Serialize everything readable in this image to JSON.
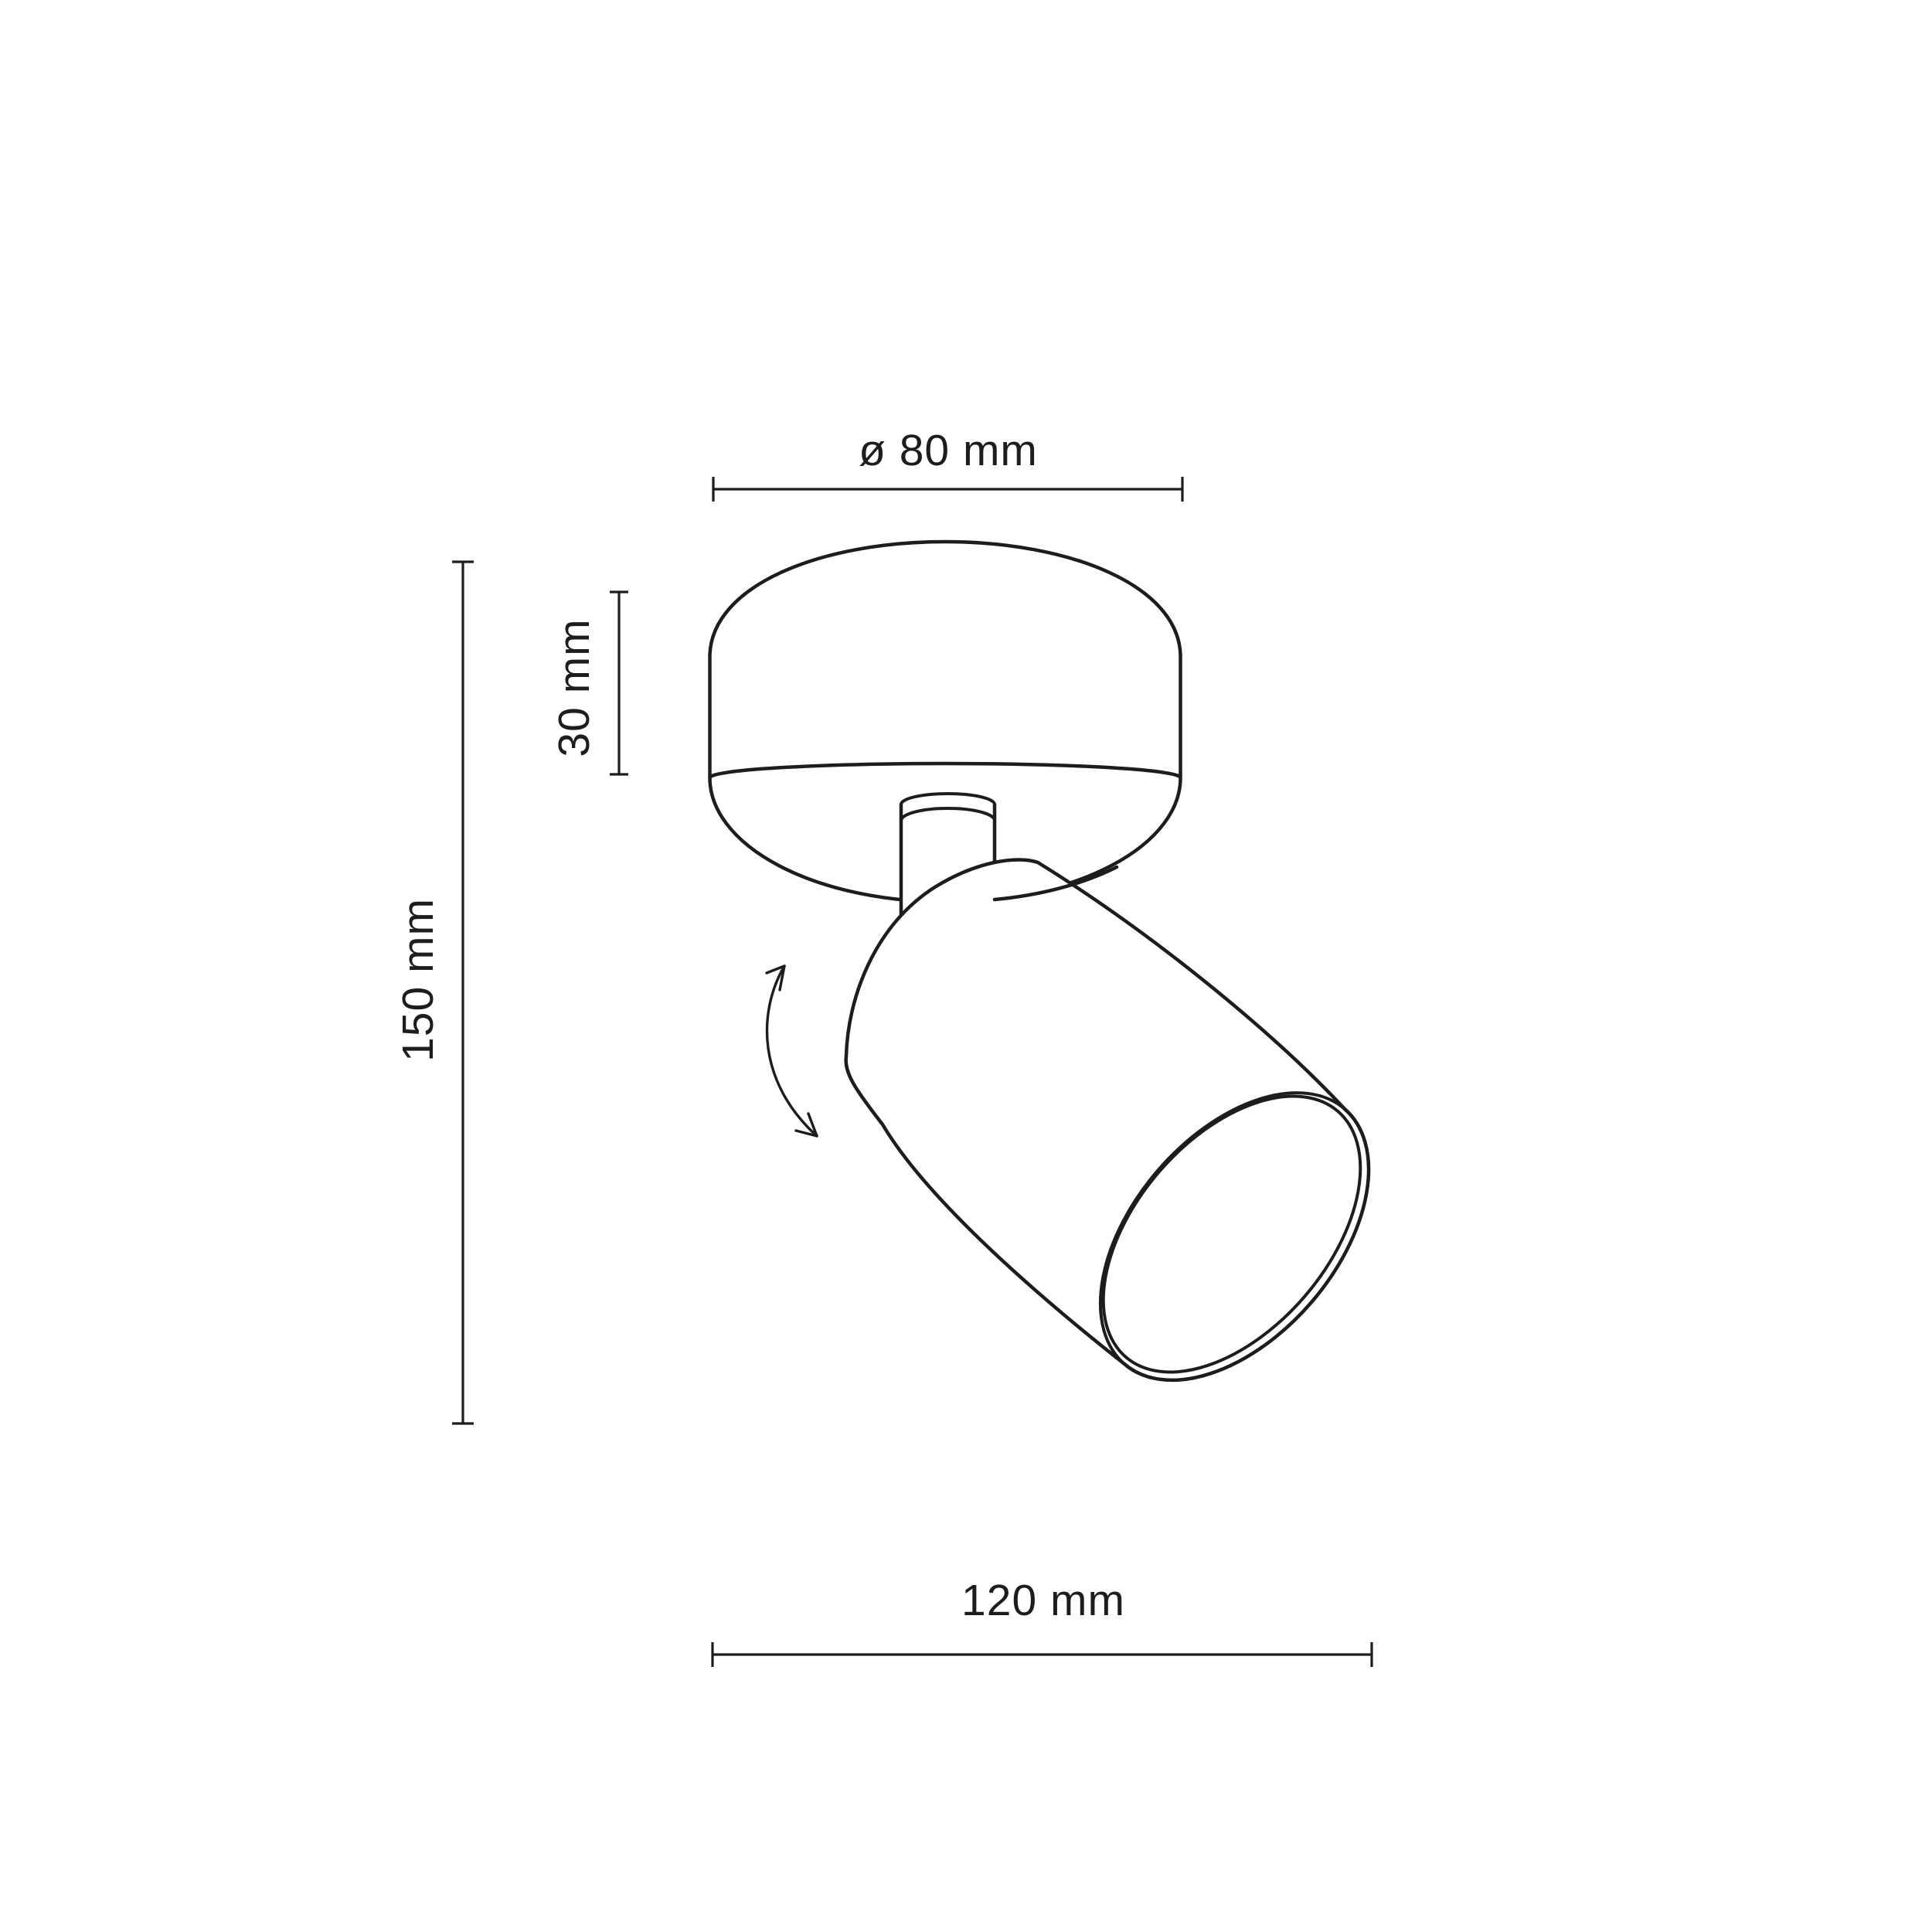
{
  "colors": {
    "background": "#ffffff",
    "line": "#1d1d1b"
  },
  "dimensions": {
    "diameter_label": "ø 80 mm",
    "base_height_label": "30 mm",
    "overall_height_label": "150 mm",
    "length_label": "120 mm"
  }
}
